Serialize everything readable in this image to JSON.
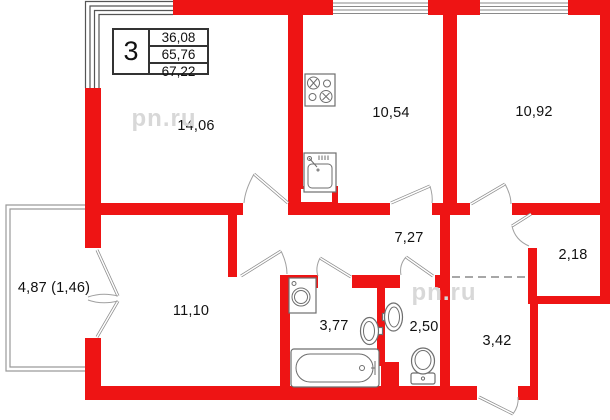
{
  "plan": {
    "info_table": {
      "rooms_count": "3",
      "values": [
        "36,08",
        "65,76",
        "67,22"
      ]
    },
    "watermark_text": "pn.ru",
    "watermarks": [
      {
        "x": 164,
        "y": 119
      },
      {
        "x": 444,
        "y": 293
      }
    ],
    "labels": [
      {
        "name": "room-14",
        "text": "14,06",
        "x": 196,
        "y": 126
      },
      {
        "name": "kitchen",
        "text": "10,54",
        "x": 391,
        "y": 113
      },
      {
        "name": "room-10-92",
        "text": "10,92",
        "x": 534,
        "y": 112
      },
      {
        "name": "hallway",
        "text": "7,27",
        "x": 409,
        "y": 238
      },
      {
        "name": "closet",
        "text": "2,18",
        "x": 573,
        "y": 255
      },
      {
        "name": "entry",
        "text": "3,42",
        "x": 497,
        "y": 341
      },
      {
        "name": "room-11-10",
        "text": "11,10",
        "x": 191,
        "y": 311
      },
      {
        "name": "bathroom",
        "text": "3,77",
        "x": 334,
        "y": 326
      },
      {
        "name": "wc",
        "text": "2,50",
        "x": 424,
        "y": 327
      },
      {
        "name": "balcony",
        "text": "4,87 (1,46)",
        "x": 54,
        "y": 288
      }
    ],
    "colors": {
      "wall": "#ee1414",
      "fixture_line": "#6e6e6e",
      "thin_line": "#9a9a9a",
      "watermark": "#d8d8d8"
    }
  }
}
